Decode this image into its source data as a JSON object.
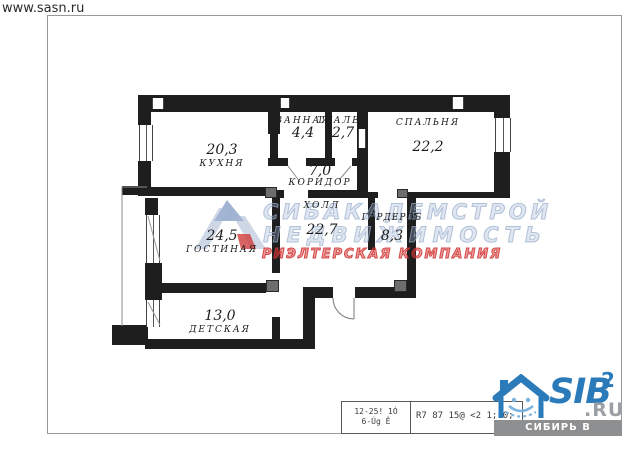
{
  "page": {
    "url": "www.sasn.ru"
  },
  "plan": {
    "rooms": {
      "kitchen": {
        "name": "КУХНЯ",
        "area": "20,3"
      },
      "bathroom": {
        "name": "ВАННАЯ",
        "area": "4,4"
      },
      "toilet": {
        "name": "ТУАЛЕТ",
        "area": "2,7"
      },
      "bedroom": {
        "name": "СПАЛЬНЯ",
        "area": "22,2"
      },
      "corridor": {
        "name": "КОРИДОР",
        "area": "7,0"
      },
      "hall": {
        "name": "ХОЛЛ",
        "area": "22,7"
      },
      "wardrobe": {
        "name": "ГАРДЕРОБ",
        "area": "8,3"
      },
      "living": {
        "name": "ГОСТИНАЯ",
        "area": "24,5"
      },
      "kids": {
        "name": "ДЕТСКАЯ",
        "area": "13,0"
      }
    }
  },
  "watermark": {
    "line1": "СИБАКАДЕМСТРОЙ",
    "line2": "НЕДВИЖИМОСТЬ",
    "line3": "РИЭЛТЕРСКАЯ КОМПАНИЯ"
  },
  "stamp": {
    "cell1_line1": "12-25! 1Ó",
    "cell1_line2": "6-Úg Ê",
    "cell2": "R7 87 15@ <2 1; 0;"
  },
  "sib_logo": {
    "name": "SIB",
    "sup": "2",
    "domain": ".RU",
    "tagline": "СИБИРЬ В КВАДРАТЕ"
  },
  "colors": {
    "wall": "#1e1e1e",
    "watermark_blue": "#9eb0ca",
    "watermark_red": "#d24848",
    "sib_blue": "#2b7ab9",
    "bar_gray": "#8d8f90"
  }
}
